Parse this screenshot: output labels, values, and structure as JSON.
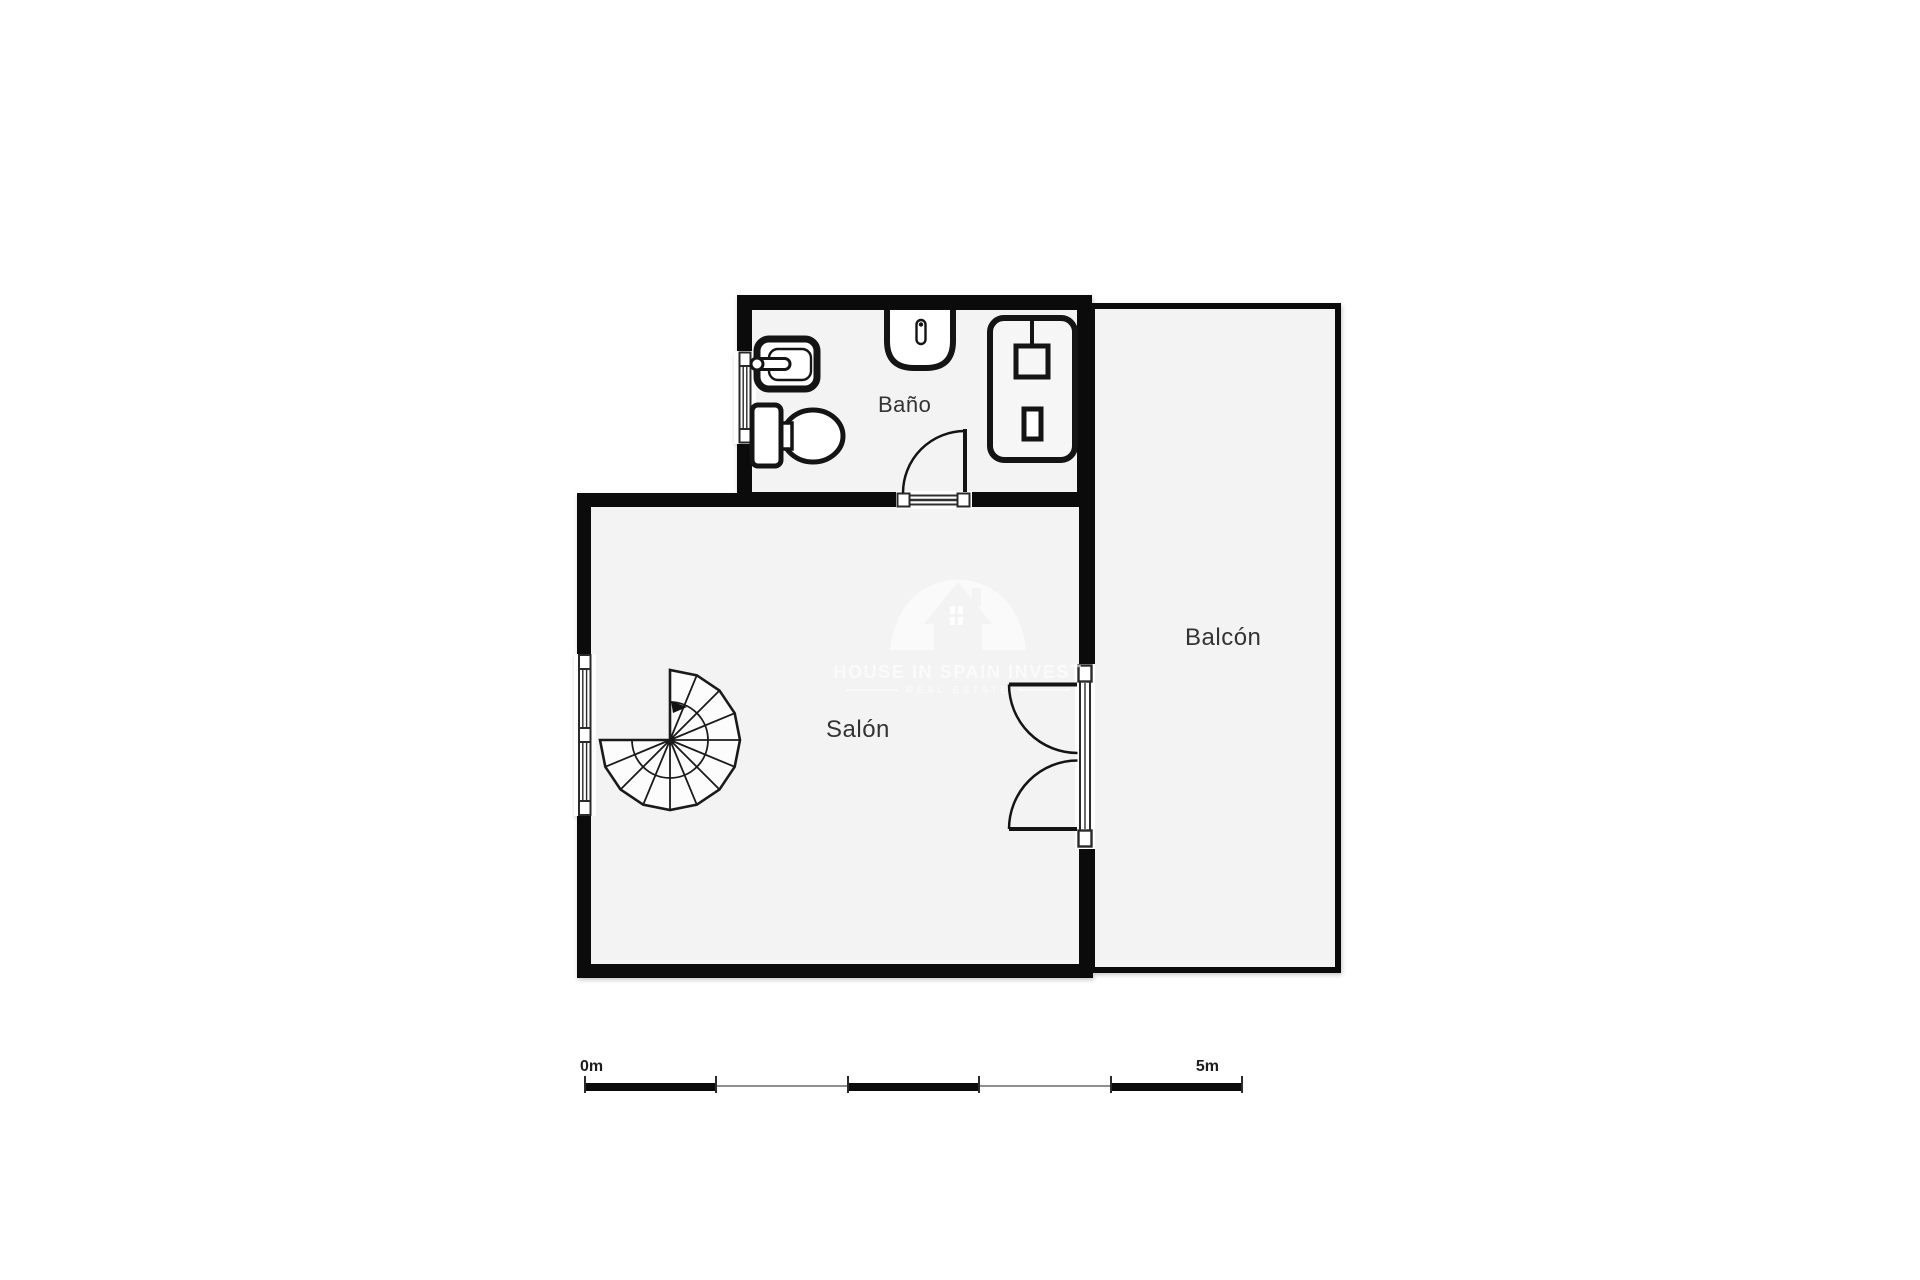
{
  "plan": {
    "rooms": [
      {
        "id": "bano",
        "label": "Baño"
      },
      {
        "id": "salon",
        "label": "Salón"
      },
      {
        "id": "balcon",
        "label": "Balcón"
      }
    ],
    "fixtures": [
      "sink-icon",
      "toilet-icon",
      "washbasin-icon",
      "shower-icon",
      "spiral-staircase-icon",
      "door-swing-arc",
      "french-doors",
      "window"
    ]
  },
  "watermark": {
    "line1": "HOUSE IN SPAIN INVEST",
    "line2": "REAL ESTATE"
  },
  "scale_bar": {
    "start_label": "0m",
    "end_label": "5m",
    "segments": 5
  },
  "colors": {
    "wall": "#0b0b0b",
    "floor": "#f3f3f3",
    "background": "#ffffff",
    "scale_gray": "#8e8e8e",
    "label_text": "#333333",
    "watermark": "#ffffff"
  }
}
